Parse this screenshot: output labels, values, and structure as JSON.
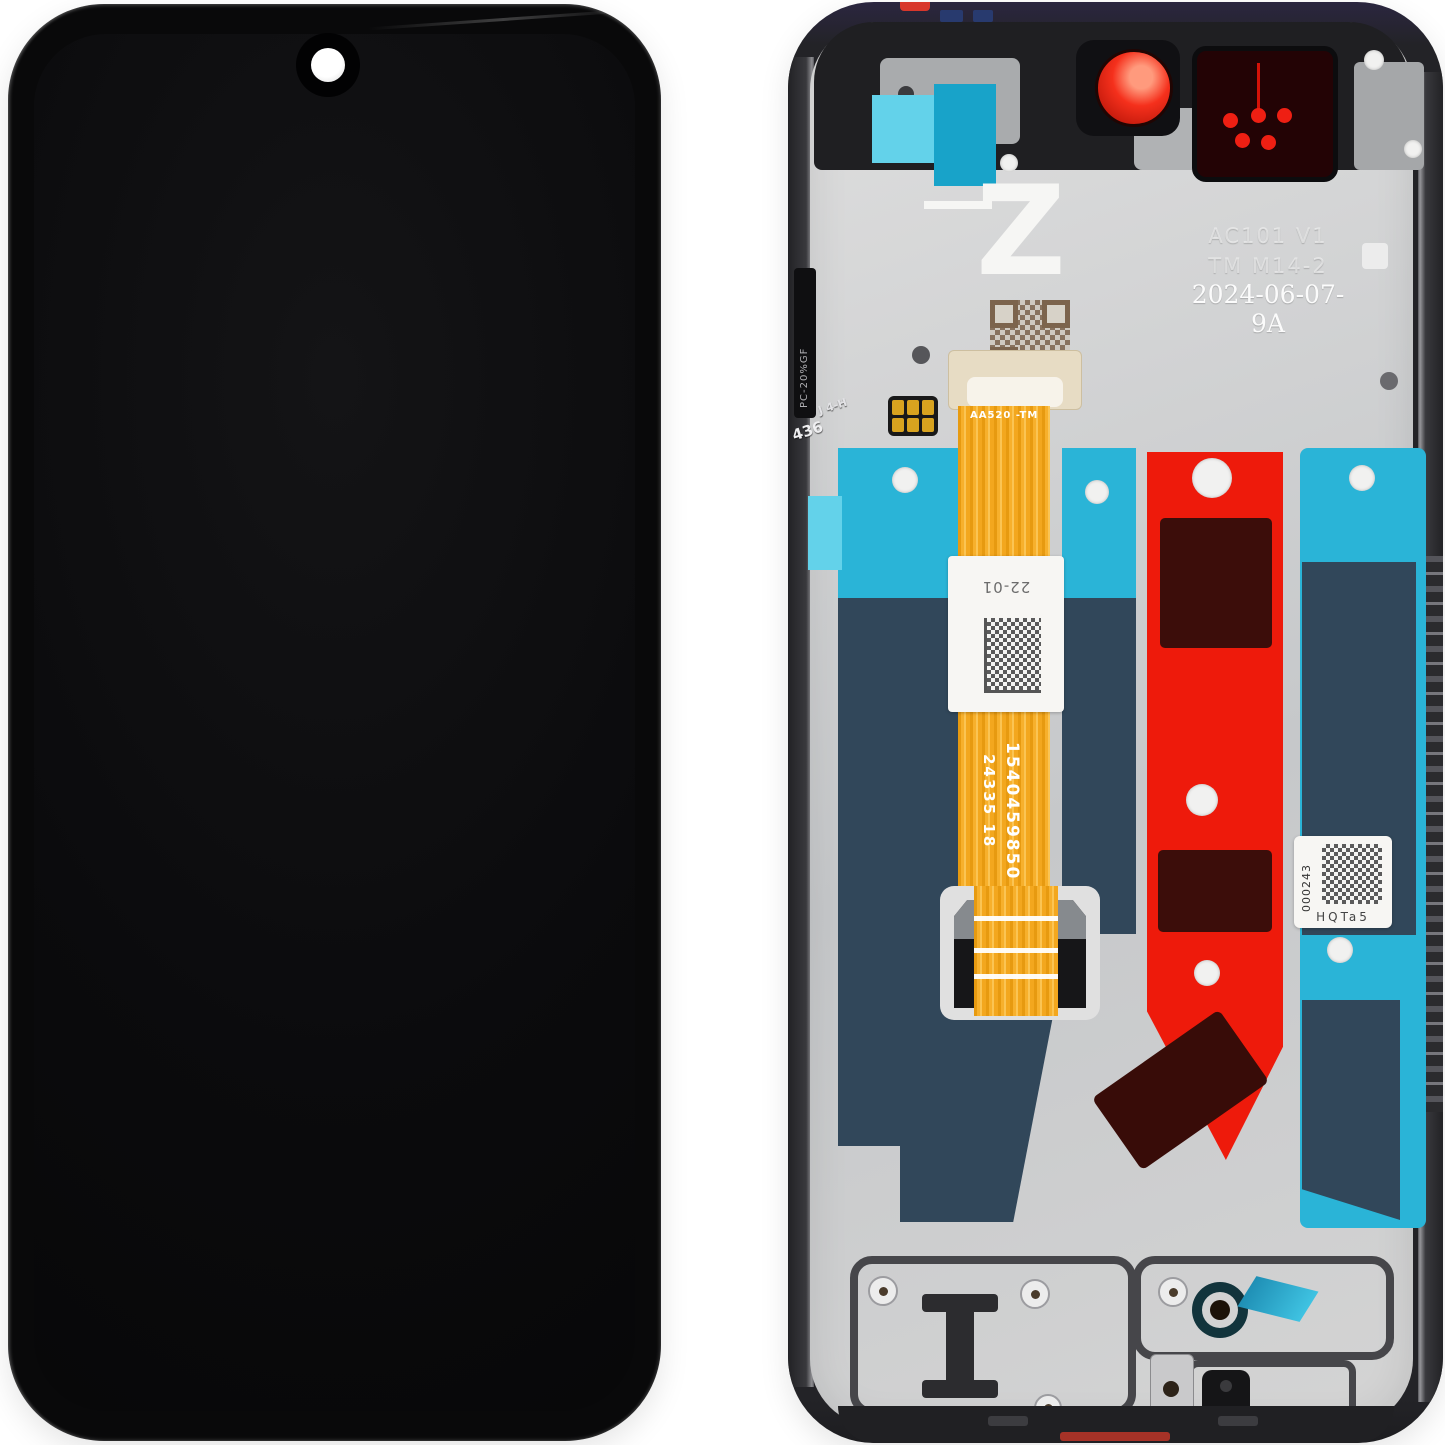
{
  "scene": {
    "description": "Phone LCD display assembly with frame, front view (left) and rear view (right)",
    "background": "#ffffff"
  },
  "front_view": {
    "features": [
      "punch-hole-camera"
    ]
  },
  "back_view": {
    "markings": {
      "logo": "Z",
      "shield_code_line1": "AC101 V1",
      "shield_code_line2": "TM M14-2",
      "shield_date_code": "2024-06-07-9A",
      "flex_cable_code": "AA520  -TM",
      "flex_sticker_code": "22-01",
      "flex_serial_main": "1540459850",
      "flex_serial_sub": "24335  18",
      "right_label_serial": "000243",
      "right_label_code": "HQTa5",
      "side_material_marking": "PC-20%GF",
      "mold_marking_number": "436",
      "mold_marking_cavity": "J 4-H"
    },
    "colors": {
      "red-tape": "#ee1a0b",
      "maroon": "#3c0d0a",
      "cyan-tape": "#2ab4d7",
      "cyan-light": "#63d2ea",
      "navy-tape": "#31475a",
      "flex-orange": "#f3a71e",
      "lens-red": "#f5301c",
      "metal-silver": "#cdced0",
      "frame-dark": "#232327"
    }
  }
}
